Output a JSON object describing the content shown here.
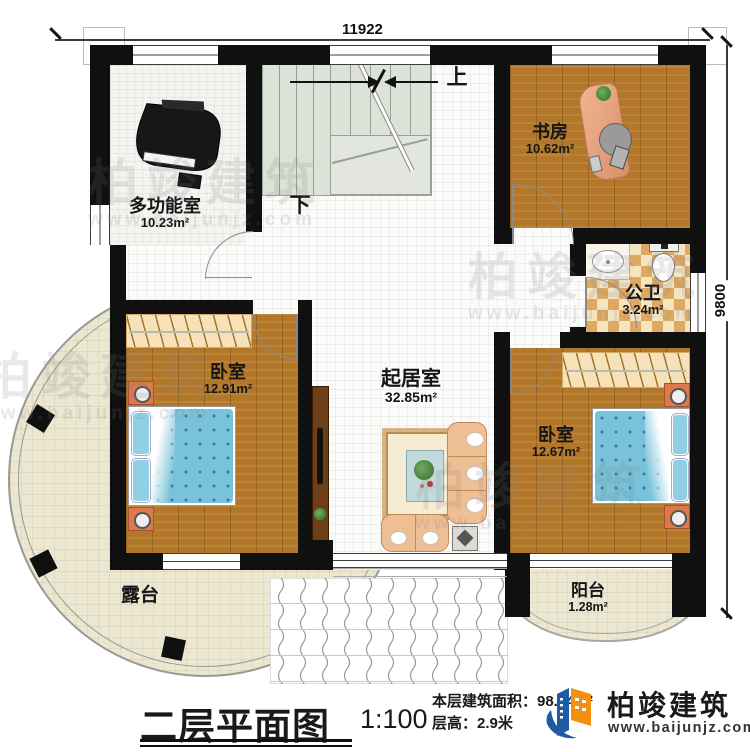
{
  "plan": {
    "title": "二层平面图",
    "scale": "1:100",
    "info_area": "本层建筑面积：98.84m²",
    "info_height": "层高：2.9米"
  },
  "logo": {
    "name": "柏竣建筑",
    "url": "www.baijunjz.com"
  },
  "dims": {
    "top": "11922",
    "right": "9800"
  },
  "stairs": {
    "up": "上",
    "down": "下"
  },
  "rooms": {
    "multi": {
      "name": "多功能室",
      "area": "10.23m²"
    },
    "study": {
      "name": "书房",
      "area": "10.62m²"
    },
    "bath": {
      "name": "公卫",
      "area": "3.24m²"
    },
    "living": {
      "name": "起居室",
      "area": "32.85m²"
    },
    "bed_left": {
      "name": "卧室",
      "area": "12.91m²"
    },
    "bed_right": {
      "name": "卧室",
      "area": "12.67m²"
    },
    "terrace": {
      "name": "露台"
    },
    "balcony": {
      "name": "阳台",
      "area": "1.28m²"
    }
  },
  "watermark": {
    "text": "柏竣建筑",
    "url": "www.baijunjz.com"
  }
}
